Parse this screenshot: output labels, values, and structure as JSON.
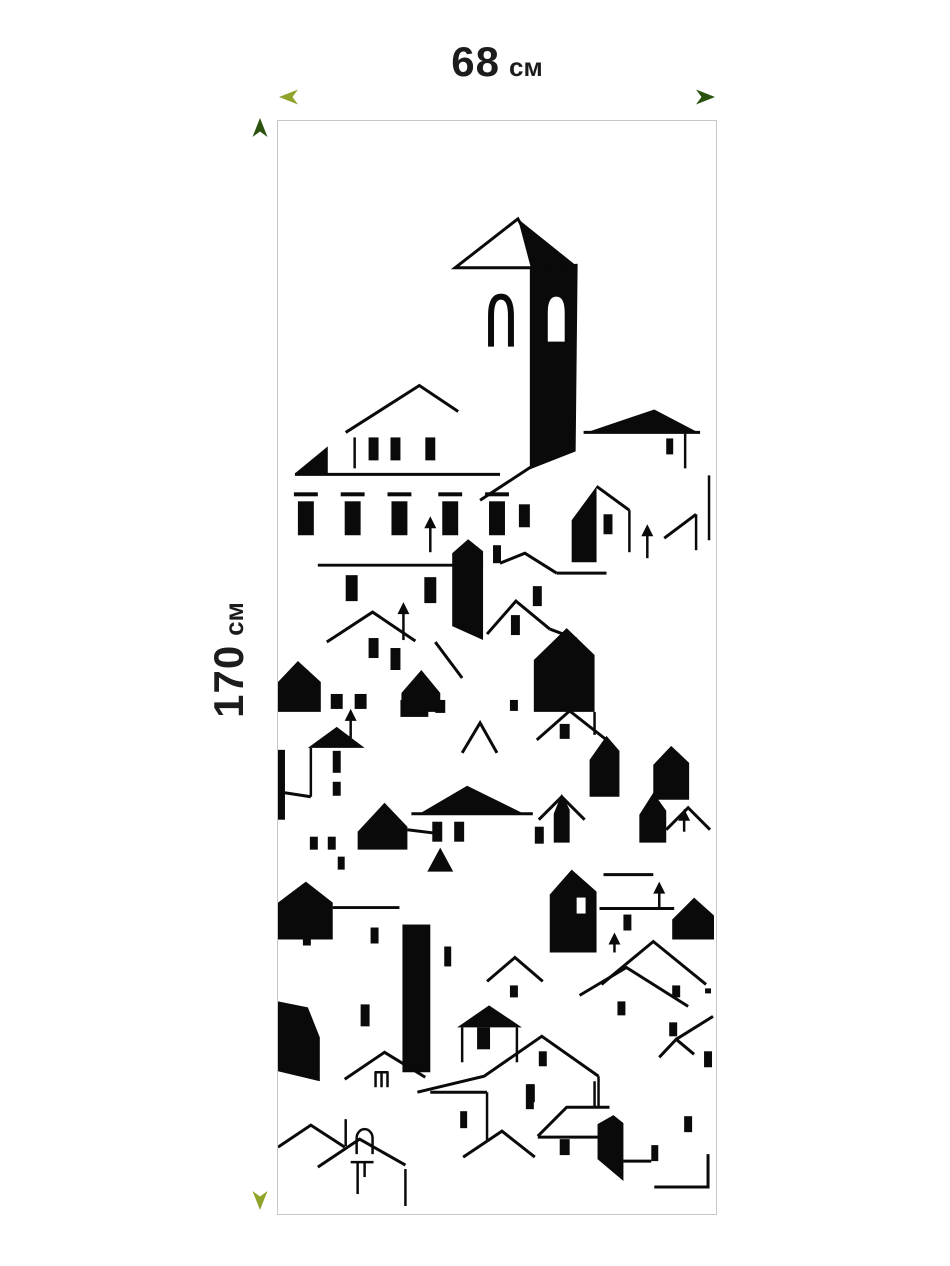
{
  "dimensions": {
    "width": {
      "value": "68",
      "unit": "см"
    },
    "height": {
      "value": "170",
      "unit": "см"
    }
  },
  "artwork": {
    "name": "black-and-white-town-silhouette-panel"
  },
  "colors": {
    "arrow_light": "#8ea42b",
    "arrow_dark": "#2b520f",
    "art": "#0a0a0a",
    "panel_border": "#c8c8c8",
    "label_text": "#1c1c1c",
    "background": "#ffffff"
  }
}
